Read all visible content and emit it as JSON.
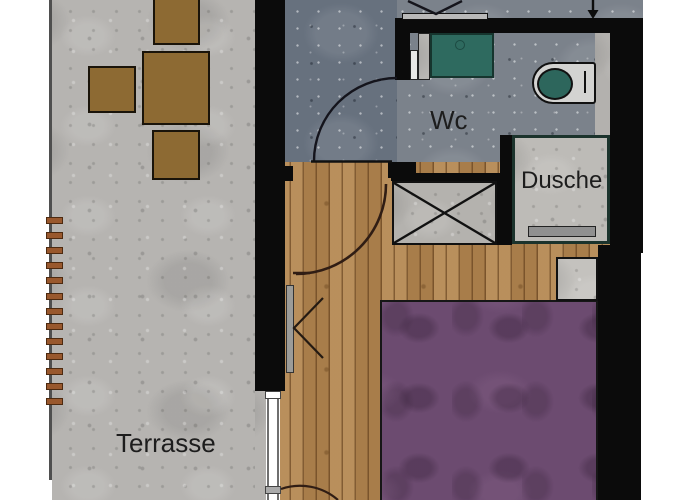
{
  "labels": {
    "terrace": "Terrasse",
    "wc": "Wc",
    "shower": "Dusche"
  },
  "terrace": {
    "slat_count": 13
  },
  "colors": {
    "wall": "#0b0b0b",
    "terrace_floor": "#b6b4b1",
    "hall_floor": "#67717e",
    "wc_floor": "#7b828b",
    "wood_floor": "#b18652",
    "bed": "#6c4b70",
    "sink": "#2e6a5f",
    "toilet_seat": "#2d665c",
    "shower_floor": "#bdbbb7",
    "shaft_floor": "#b4b2ae",
    "nightstand": "#c4c2be",
    "furniture": "#8d6a33",
    "slat": "#99582d",
    "drain": "#909090",
    "window_strip": "#9c9c99",
    "door_bar": "#b9b9b9",
    "label_text": "#1d1d1d"
  }
}
